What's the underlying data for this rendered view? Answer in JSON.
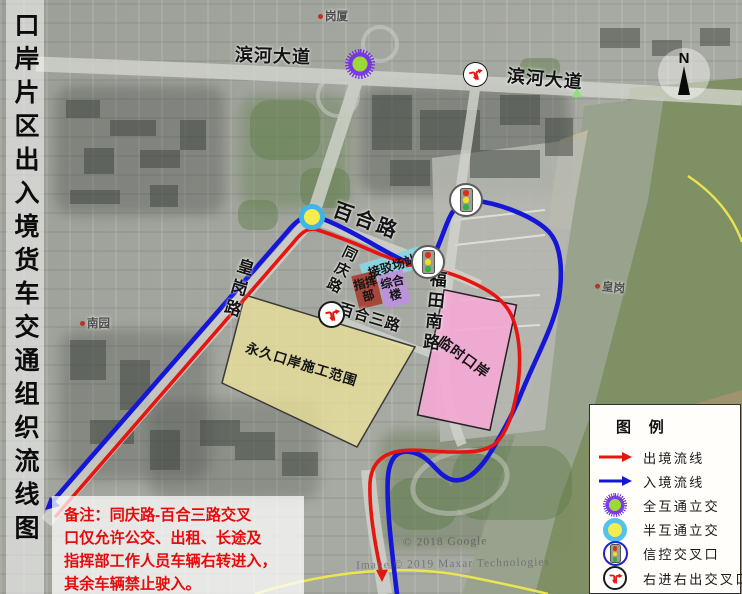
{
  "title": "口岸片区出入境货车交通组织流线图",
  "compass": {
    "label": "N"
  },
  "road_labels": {
    "binhe_w": "滨河大道",
    "binhe_e": "滨河大道",
    "baihe": "百合路",
    "tongqing": "同庆路",
    "huanggang": "皇岗路",
    "futian_nan": "福田南路",
    "baihe_san": "百合三路"
  },
  "areas": {
    "yongjiu": "永久口岸施工范围",
    "linshi": "临时口岸",
    "jiebo": "接驳场站",
    "zonghe": "综合楼",
    "zhihui": "指挥部"
  },
  "places": {
    "gangxia": "岗厦",
    "nanyuan": "南园",
    "huanggang_dong": "皇岗"
  },
  "note": {
    "line1": "备注：同庆路-百合三路交叉",
    "line2": "口仅允许公交、出租、长途及",
    "line3": "指挥部工作人员车辆右转进入，",
    "line4": "其余车辆禁止驶入。"
  },
  "legend": {
    "title": "图 例",
    "items": [
      {
        "icon": "exit-flow-arrow",
        "label": "出境流线"
      },
      {
        "icon": "entry-flow-arrow",
        "label": "入境流线"
      },
      {
        "icon": "full-interchange",
        "label": "全互通立交"
      },
      {
        "icon": "half-interchange",
        "label": "半互通立交"
      },
      {
        "icon": "signal-intersection",
        "label": "信控交叉口"
      },
      {
        "icon": "right-in-right-out",
        "label": "右进右出交叉口"
      }
    ]
  },
  "watermarks": {
    "google": "© 2018 Google",
    "maxar": "Image © 2019 Maxar Technologies"
  },
  "colors": {
    "exit_flow": "#e81410",
    "entry_flow": "#1617d6",
    "boundary_line": "#eee84e",
    "construction_fill": "#eae29a",
    "temporary_fill": "#f3a9d3",
    "shuttle_fill": "#8ed2e0",
    "complex_fill": "#ba93da",
    "command_fill": "#a7463a"
  }
}
